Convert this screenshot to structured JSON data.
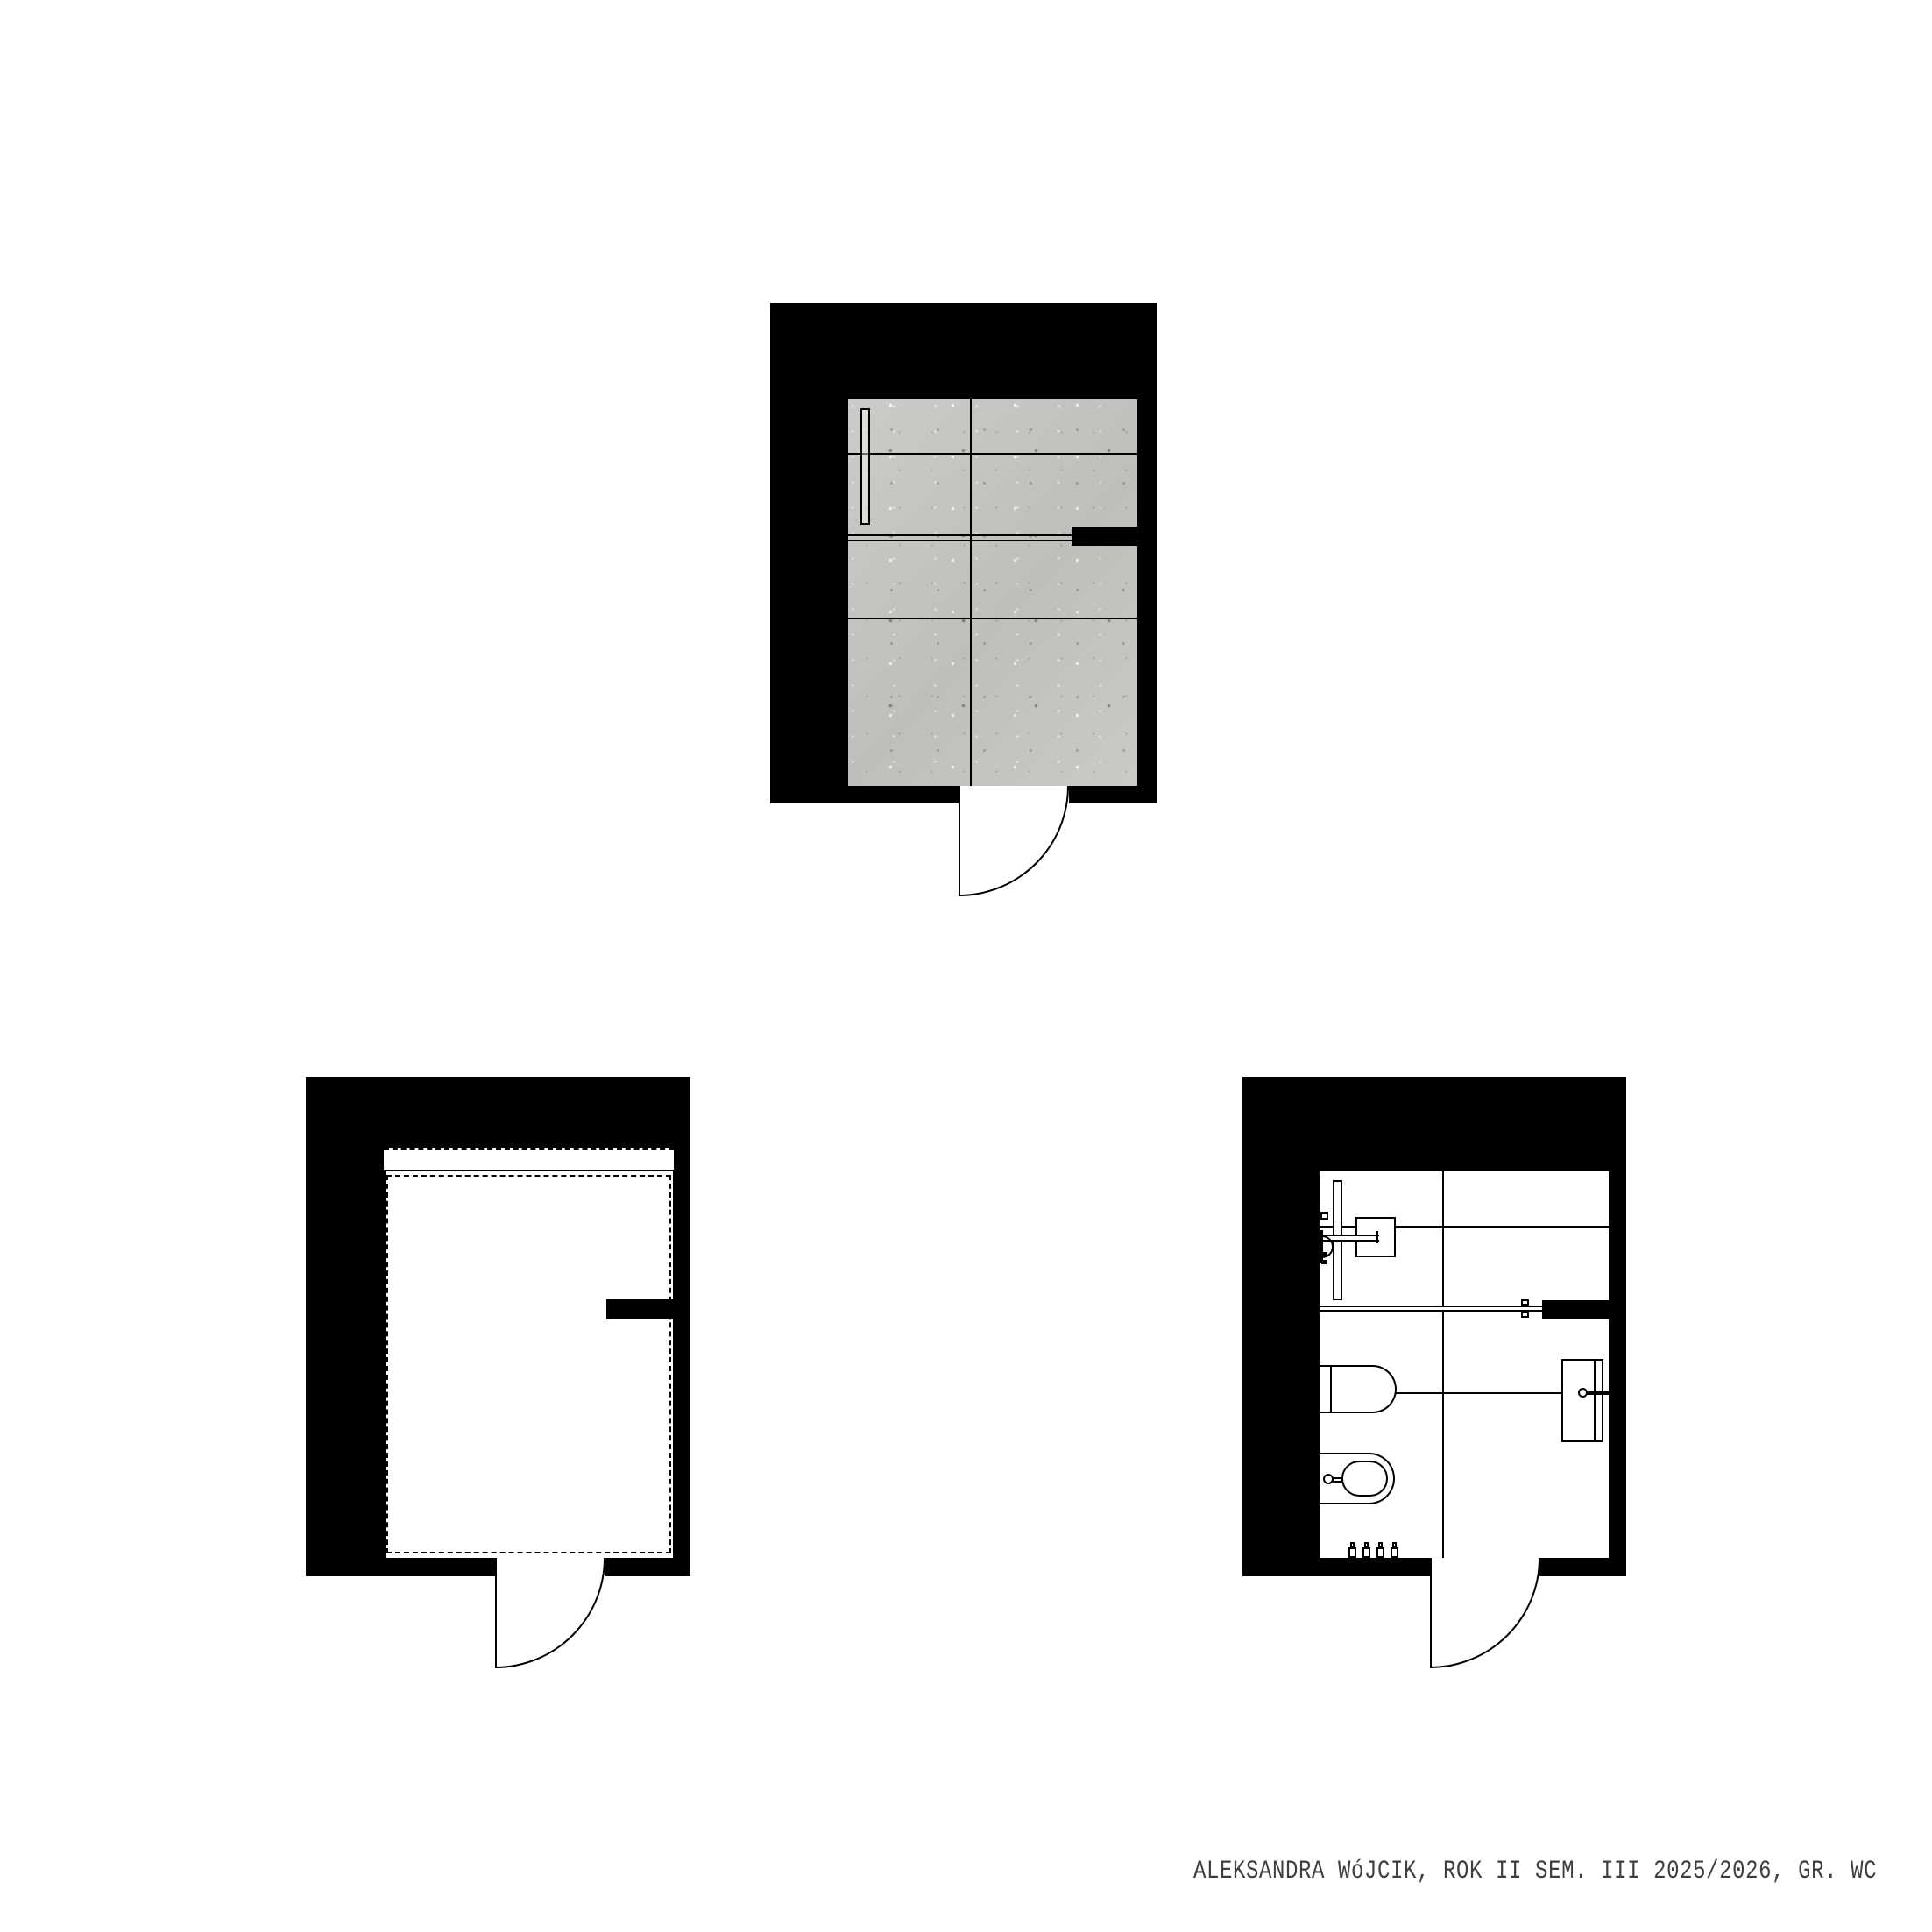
{
  "footer": {
    "text": "ALEKSANDRA WóJCIK, ROK II SEM. III 2025/2026, GR. WC"
  },
  "colors": {
    "background": "#ffffff",
    "wall": "#000000",
    "line": "#000000",
    "tile": "#c8c7c3",
    "footer_text": "#3f3f3f"
  },
  "plans": {
    "floor_finishes_plan": [
      "tile-floor",
      "linear-drain",
      "glass-partition",
      "partition-wall-stub",
      "door-swing"
    ],
    "ceiling_plan": [
      "ceiling-cove-band",
      "suspended-ceiling-outline",
      "partition-wall-stub",
      "door-swing"
    ],
    "fixtures_plan": [
      "shower-glass-panel",
      "shower-head",
      "shower-arm",
      "shower-mixer",
      "glass-partition",
      "partition-wall-stub",
      "wall-hung-wc",
      "bidet",
      "flush-knob",
      "washbasin",
      "faucet",
      "supply-valves",
      "door-swing"
    ]
  }
}
